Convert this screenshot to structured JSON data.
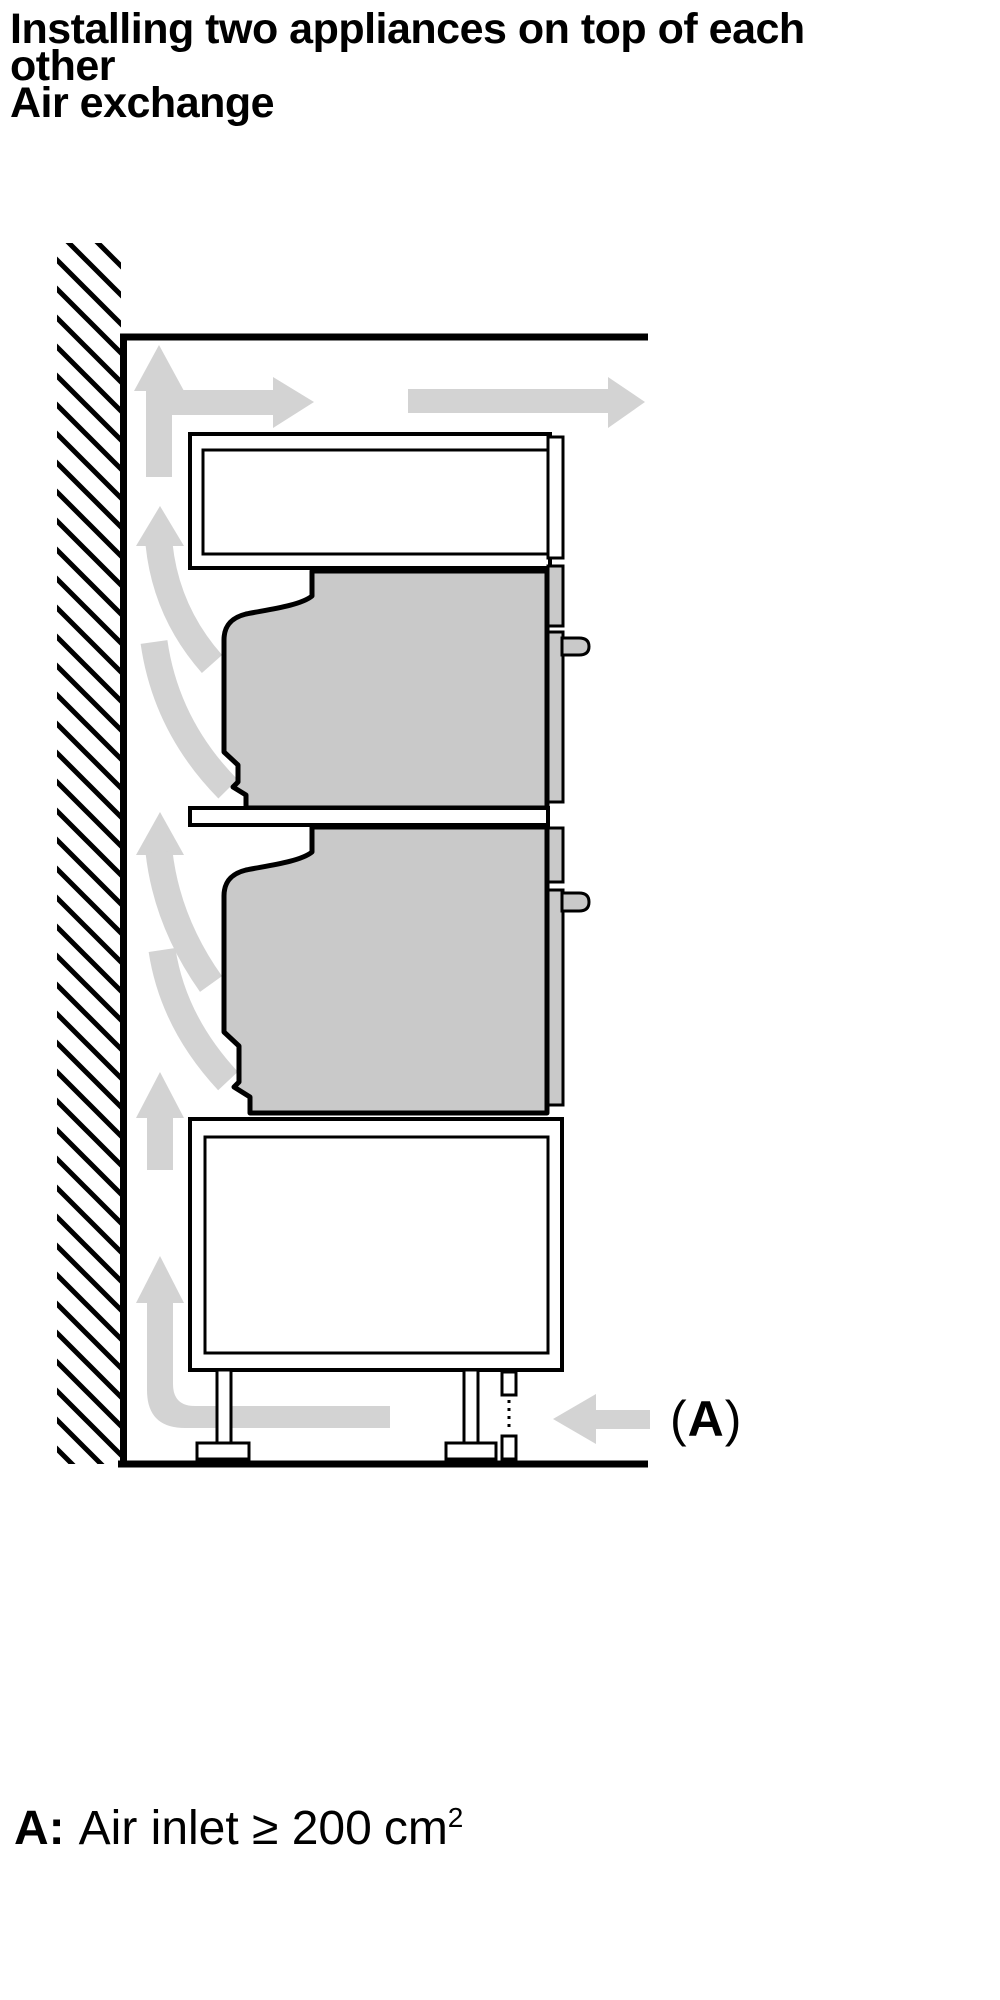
{
  "title": {
    "lines": [
      "Installing two appliances on top of each",
      "other",
      "Air exchange"
    ]
  },
  "figure": {
    "label_a": {
      "open": "(",
      "letter": "A",
      "close": ")"
    },
    "colors": {
      "appliance_fill": "#c9c9c9",
      "airflow_fill": "#d3d3d3",
      "outline": "#000000",
      "background": "#ffffff"
    }
  },
  "legend": {
    "prefix": "A:",
    "body": "Air inlet ≥ 200",
    "unit": "cm",
    "exponent": "2"
  }
}
